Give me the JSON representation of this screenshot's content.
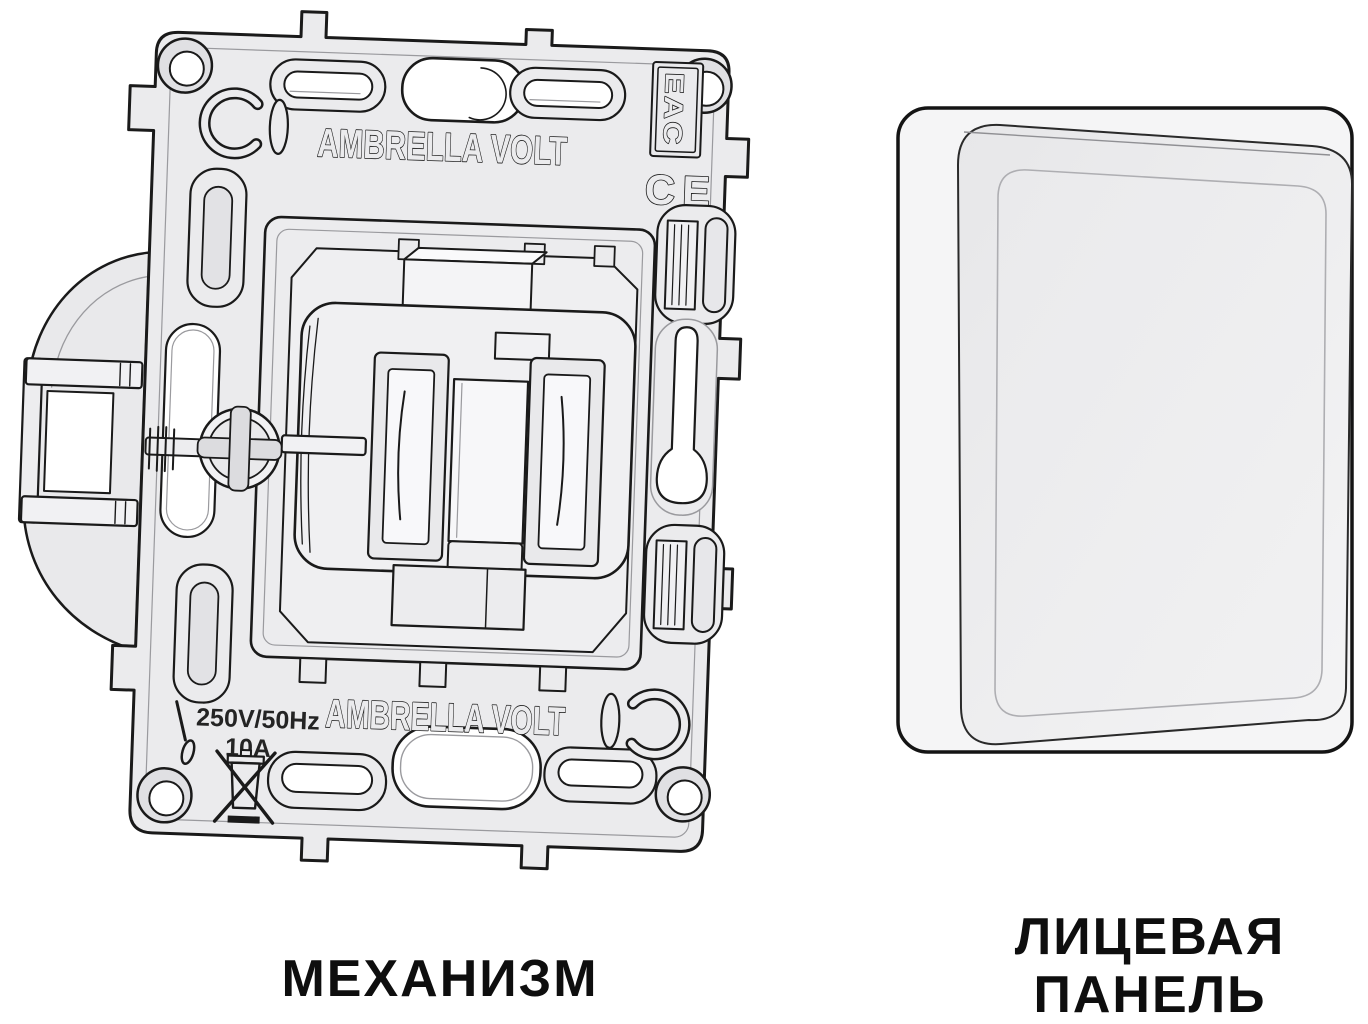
{
  "captions": {
    "mechanism": "МЕХАНИЗМ",
    "faceplate_line1": "ЛИЦЕВАЯ",
    "faceplate_line2": "ПАНЕЛЬ"
  },
  "markings": {
    "brand_top": "AMBRELLA VOLT",
    "brand_bottom": "AMBRELLA VOLT",
    "eac": "EAC",
    "ce": "CE",
    "voltage": "250V/50Hz",
    "current": "10A"
  },
  "icons": {
    "weee": "crossed-out-wheelie-bin",
    "screwdriver": "flat-screwdriver",
    "mold_mark": "c-in-circle"
  },
  "colors": {
    "outline": "#1a1a1a",
    "metal_fill": "#ebebed",
    "hole_fill": "#ffffff",
    "caption_text": "#0e0e0e"
  }
}
